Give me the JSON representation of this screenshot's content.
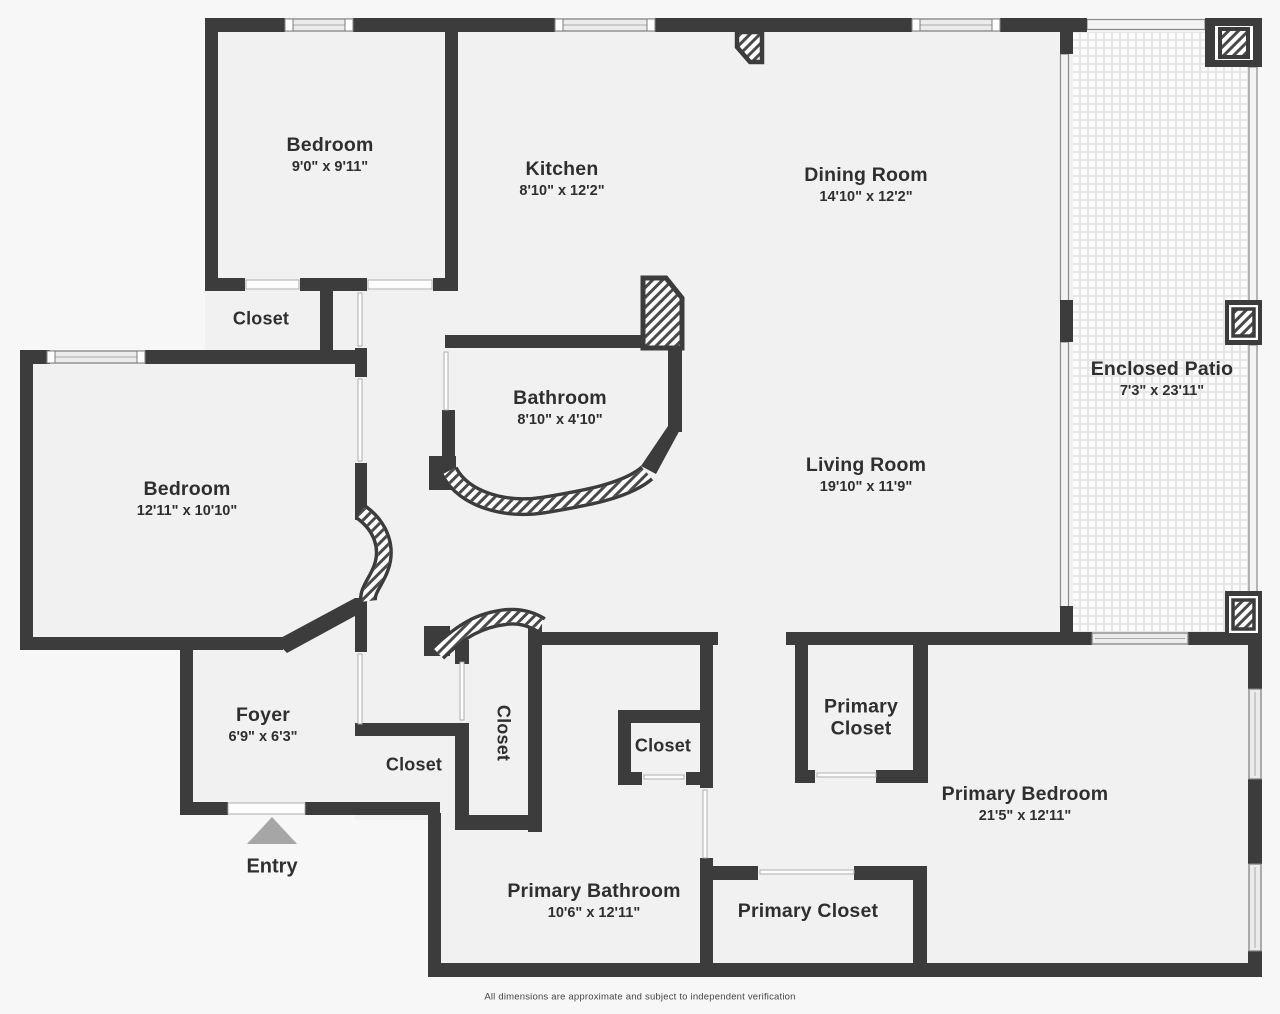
{
  "plan": {
    "title": "floor-plan",
    "disclaimer": "All dimensions are approximate and subject to independent verification",
    "entry": {
      "label": "Entry",
      "arrow_icon": "triangle-up"
    },
    "colors": {
      "wall": "#3c3c3c",
      "floor": "#f1f1f1",
      "background": "#f7f7f7",
      "entry_arrow": "#a6a6a6",
      "hatch": "#4a4a4a"
    },
    "rooms": [
      {
        "name": "Bedroom",
        "dims": "9'0\" x 9'11\""
      },
      {
        "name": "Kitchen",
        "dims": "8'10\" x 12'2\""
      },
      {
        "name": "Dining Room",
        "dims": "14'10\" x 12'2\""
      },
      {
        "name": "Enclosed Patio",
        "dims": "7'3\" x 23'11\""
      },
      {
        "name": "Closet",
        "dims": ""
      },
      {
        "name": "Bathroom",
        "dims": "8'10\" x 4'10\""
      },
      {
        "name": "Bedroom",
        "dims": "12'11\" x 10'10\""
      },
      {
        "name": "Living Room",
        "dims": "19'10\" x 11'9\""
      },
      {
        "name": "Foyer",
        "dims": "6'9\" x 6'3\""
      },
      {
        "name": "Closet",
        "dims": ""
      },
      {
        "name": "Closet",
        "dims": ""
      },
      {
        "name": "Closet",
        "dims": ""
      },
      {
        "name": "Primary Closet",
        "dims": ""
      },
      {
        "name": "Primary Bedroom",
        "dims": "21'5\" x 12'11\""
      },
      {
        "name": "Primary Bathroom",
        "dims": "10'6\" x 12'11\""
      },
      {
        "name": "Primary Closet",
        "dims": ""
      }
    ]
  }
}
